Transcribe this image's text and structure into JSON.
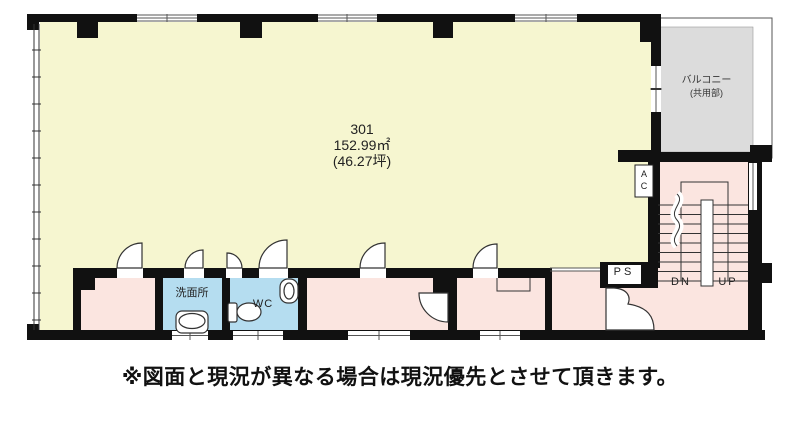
{
  "colors": {
    "room_fill": "#F6F6D0",
    "service_fill": "#FBE5E0",
    "wet_fill": "#B5DDF0",
    "balcony_fill": "#DCDCDC",
    "wall": "#111111"
  },
  "floor_plan": {
    "unit": {
      "number": "301",
      "area_sqm": "152.99㎡",
      "area_tsubo": "(46.27坪)"
    },
    "balcony": {
      "name": "バルコニー",
      "note": "(共用部)"
    },
    "rooms": {
      "washroom": "洗面所",
      "toilet": "WC"
    },
    "labels": {
      "ac_line1": "A",
      "ac_line2": "C",
      "pipe_space": "PS",
      "stairs_down": "DN",
      "stairs_up": "UP"
    }
  },
  "disclaimer": "※図面と現況が異なる場合は現況優先とさせて頂きます。"
}
